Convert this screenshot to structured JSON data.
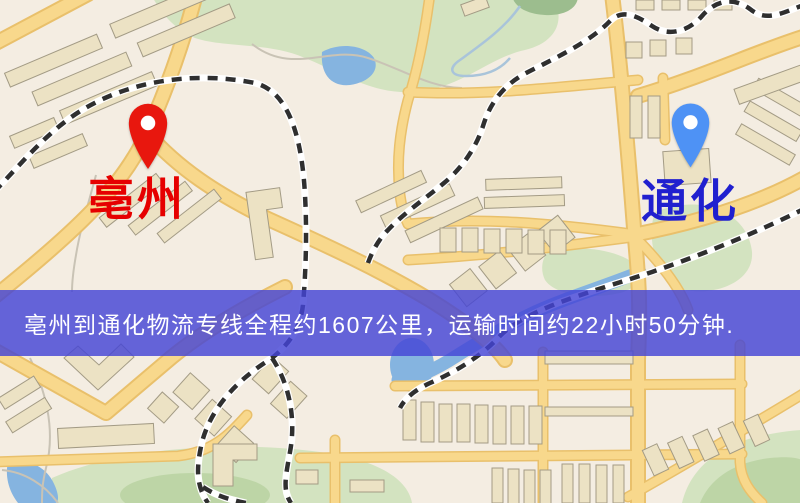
{
  "banner": {
    "text": "亳州到通化物流专线全程约1607公里，运输时间约22小时50分钟.",
    "background_color": "rgba(68,68,214,0.82)",
    "text_color": "#ffffff"
  },
  "markers": {
    "origin": {
      "name": "亳州",
      "pin_color": "#e8170e",
      "label_color": "#e60000"
    },
    "destination": {
      "name": "通化",
      "pin_color": "#4e92f5",
      "label_color": "#2020cf"
    }
  },
  "route_summary": {
    "origin": "亳州",
    "destination": "通化",
    "service": "物流专线",
    "distance_text": "约1607公里",
    "duration_text": "约22小时50分钟"
  },
  "map_palette": {
    "background": "#f4ede2",
    "road": "#f8d88c",
    "road_edge": "#e9c06b",
    "park": "#d3e3c0",
    "park_dark": "#bdd5a6",
    "pond": "#9cbd8e",
    "water": "#85b4e0",
    "railway": "#2f2f2f",
    "building": "#ece2c4"
  }
}
